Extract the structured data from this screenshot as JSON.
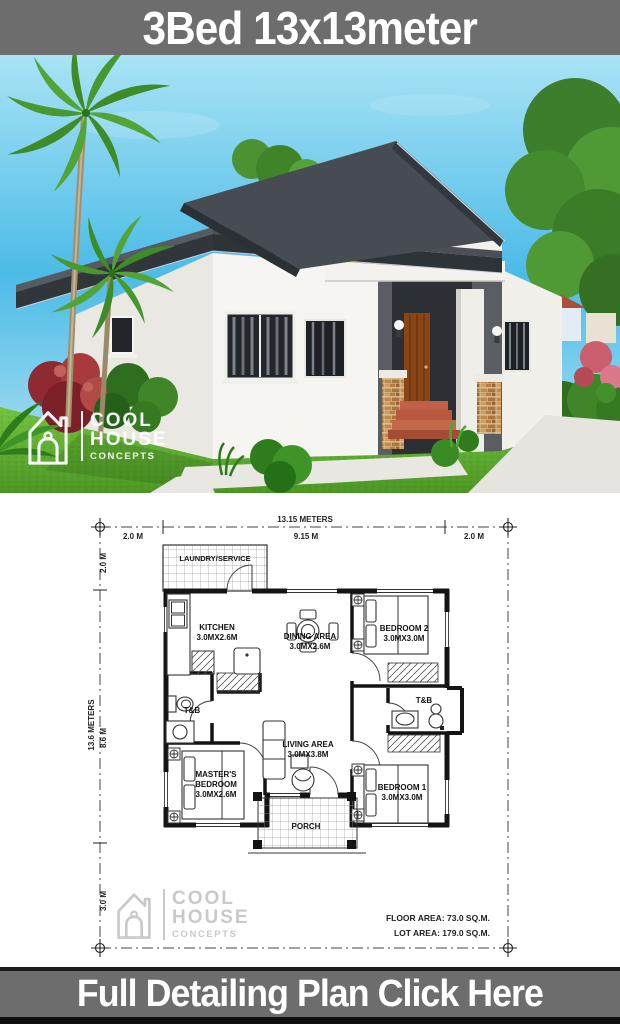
{
  "top_banner": {
    "label": "3Bed 13x13meter"
  },
  "bottom_banner": {
    "label": "Full Detailing Plan Click Here"
  },
  "logo": {
    "line1": "COOL",
    "line2": "HOUSE",
    "line3": "CONCEPTS"
  },
  "plan": {
    "dim_top": {
      "total": "13.15 METERS",
      "segments": [
        "2.0 M",
        "9.15 M",
        "2.0 M"
      ]
    },
    "dim_left": {
      "total": "13.6 METERS",
      "segments": [
        "2.0 M",
        "8.6 M",
        "3.0 M"
      ]
    },
    "rooms": {
      "laundry": {
        "label": "LAUNDRY/SERVICE"
      },
      "kitchen": {
        "label": "KITCHEN",
        "size": "3.0MX2.6M"
      },
      "dining": {
        "label": "DINING AREA",
        "size": "3.0MX2.6M"
      },
      "bedroom2": {
        "label": "BEDROOM 2",
        "size": "3.0MX3.0M"
      },
      "tb_left": {
        "label": "T&B"
      },
      "tb_right": {
        "label": "T&B"
      },
      "living": {
        "label": "LIVING AREA",
        "size": "3.0MX3.8M"
      },
      "master": {
        "line1": "MASTER'S",
        "line2": "BEDROOM",
        "size": "3.0MX2.6M"
      },
      "bedroom1": {
        "label": "BEDROOM 1",
        "size": "3.0MX3.0M"
      },
      "porch": {
        "label": "PORCH"
      }
    },
    "areas": {
      "floor": "FLOOR AREA: 73.0 SQ.M.",
      "lot": "LOT AREA: 179.0 SQ.M."
    }
  },
  "colors": {
    "banner_bg": "#6d6d6d",
    "banner_fg": "#ffffff",
    "sky_top": "#a8e3f5",
    "sky_deep": "#4cbbe7",
    "grass": "#5fae2e",
    "roof": "#3a3f44",
    "stone": "#c2925a",
    "door": "#8a4516"
  }
}
